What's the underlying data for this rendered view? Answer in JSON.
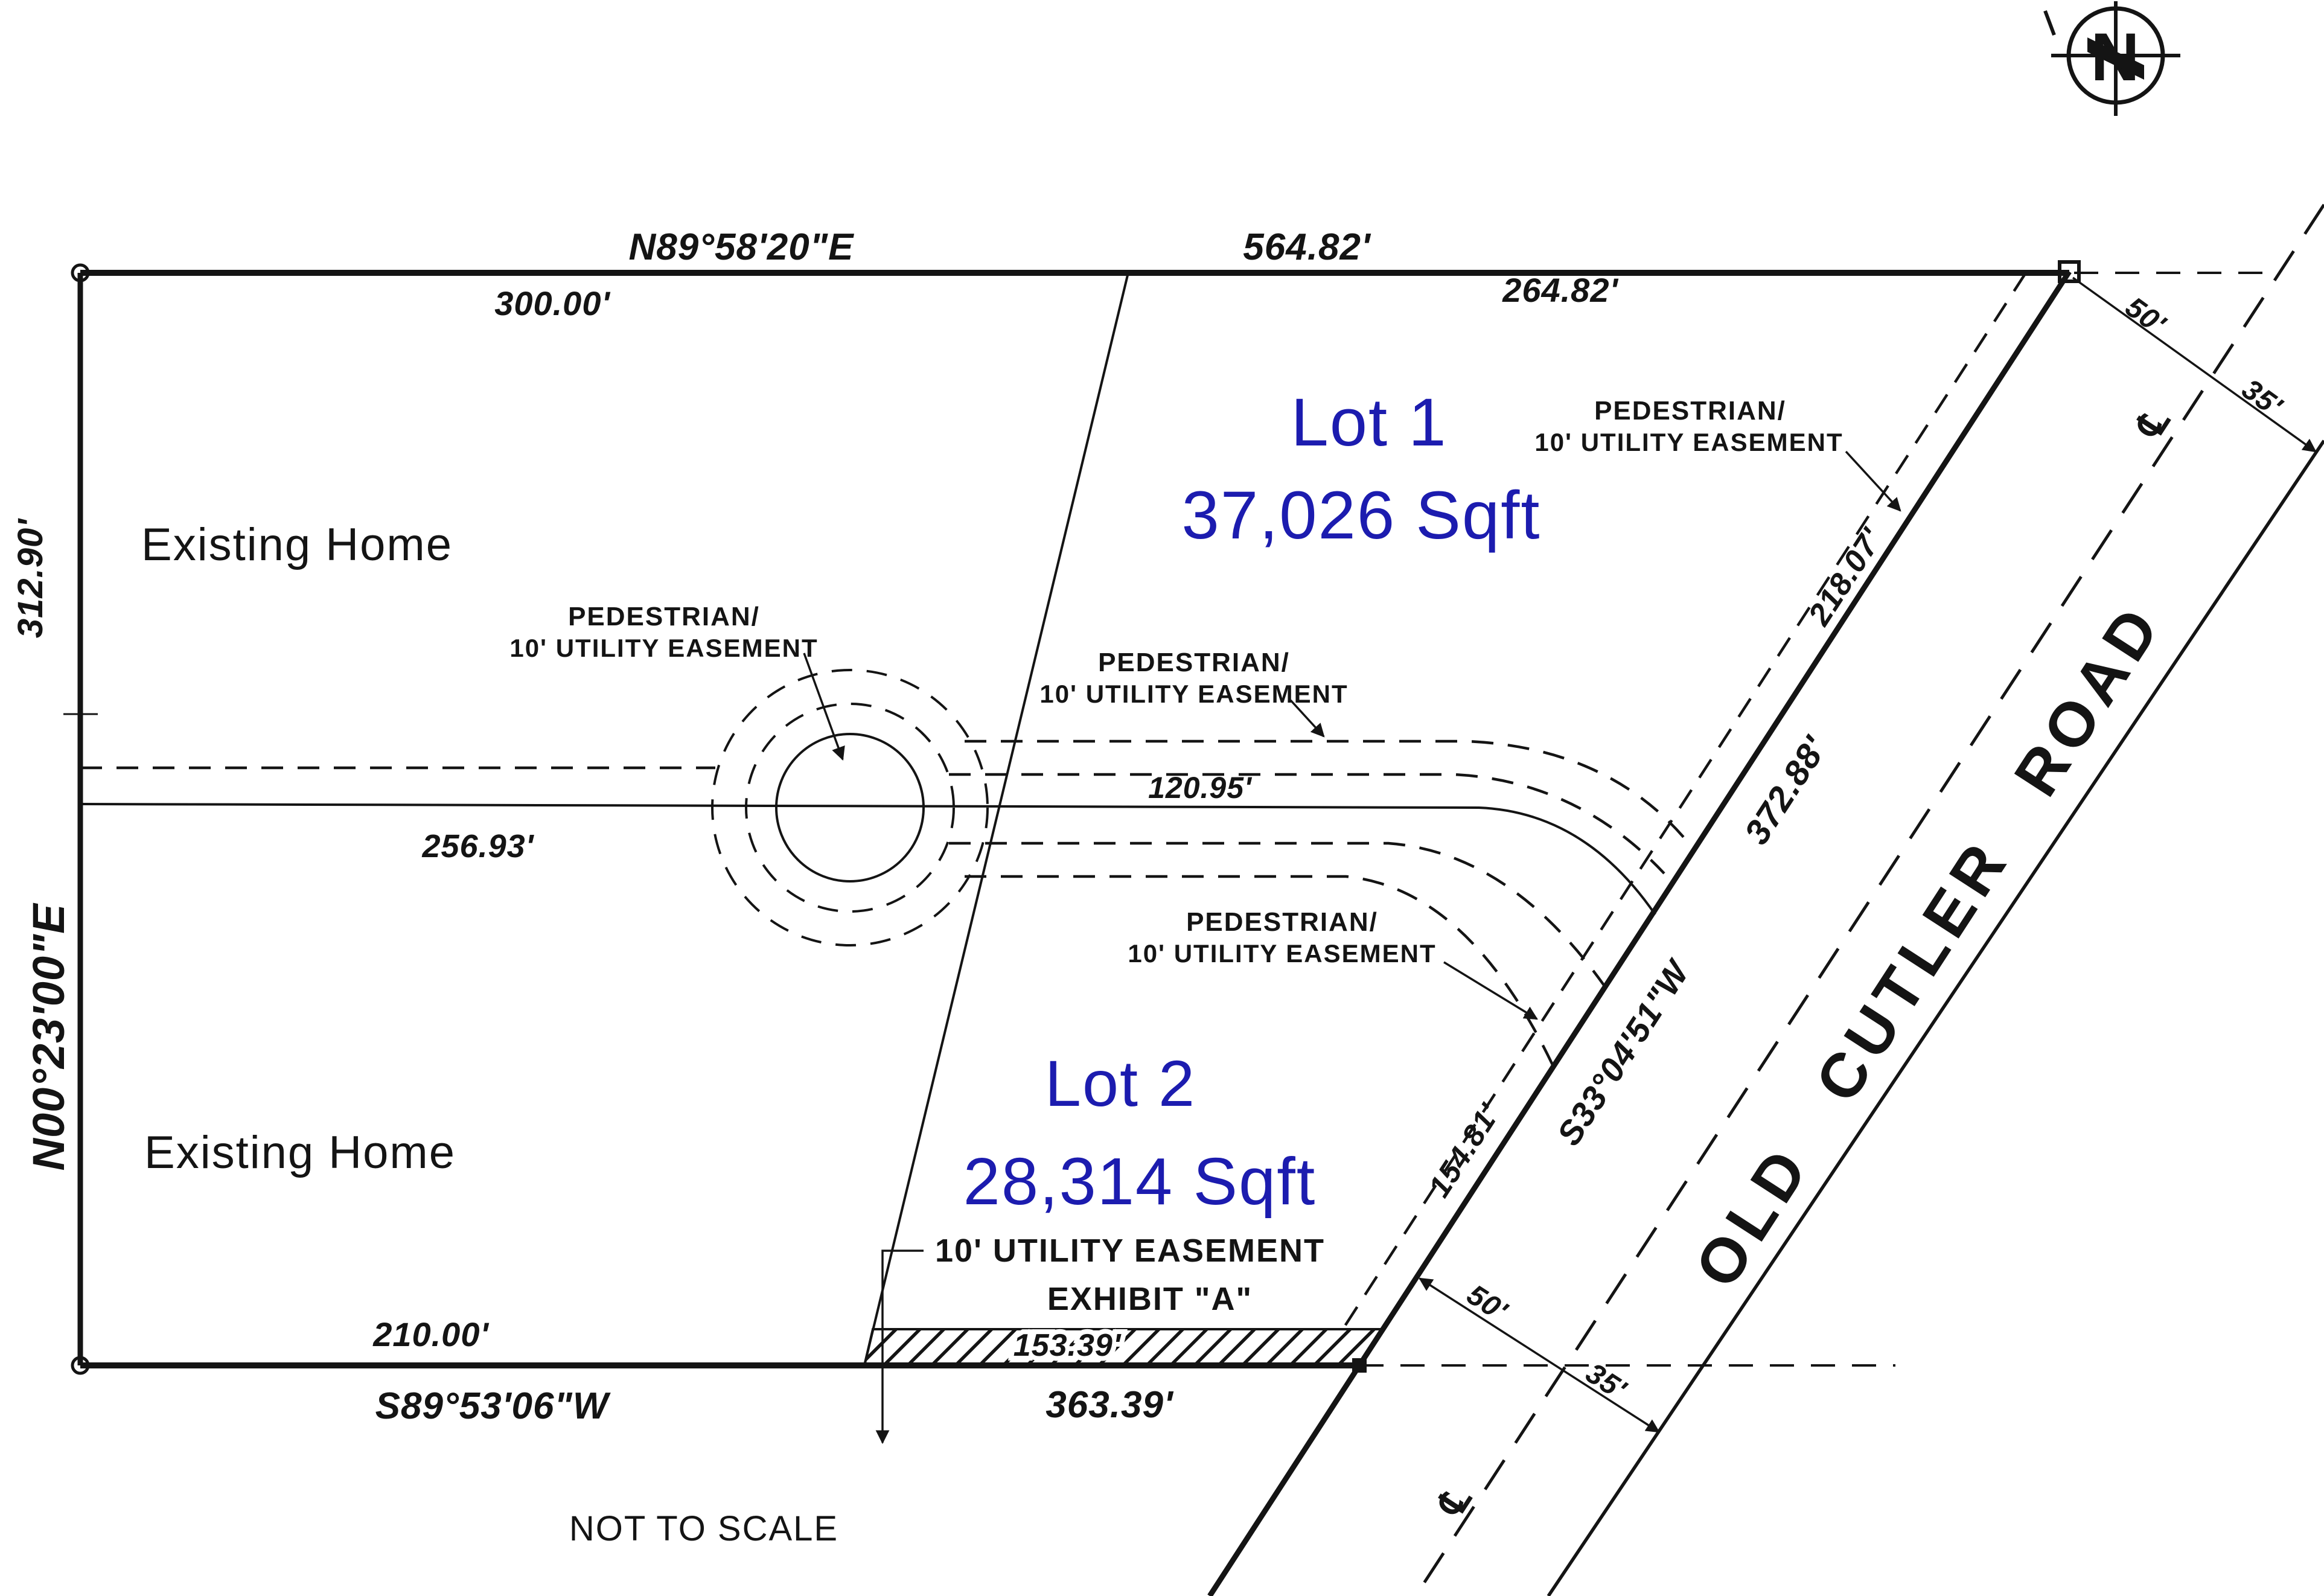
{
  "colors": {
    "ink": "#141414",
    "lot_label_blue": "#1c1caf",
    "paper": "#ffffff"
  },
  "north_arrow": {
    "letter": "N"
  },
  "boundary": {
    "north_bearing": "N89°58'20\"E",
    "north_total": "564.82'",
    "north_left_segment": "300.00'",
    "north_right_segment": "264.82'",
    "west_upper_distance": "312.90'",
    "west_bearing": "N00°23'00\"E",
    "south_left_segment": "210.00'",
    "south_bearing": "S89°53'06\"W",
    "south_total": "363.39'",
    "south_easement_segment": "153.39'",
    "road_bearing": "S33°04'51\"W",
    "road_total": "372.88'",
    "road_upper_segment": "218.07'",
    "road_lower_segment": "154.81'"
  },
  "lots": {
    "lot1_name": "Lot 1",
    "lot1_area": "37,026 Sqft",
    "lot2_name": "Lot 2",
    "lot2_area": "28,314 Sqft"
  },
  "parcels": {
    "existing_home": "Existing Home"
  },
  "interior": {
    "middle_distance": "256.93'",
    "drive_distance": "120.95'"
  },
  "easement": {
    "pedestrian_line1": "PEDESTRIAN/",
    "pedestrian_line2": "10' UTILITY EASEMENT",
    "south_label": "10' UTILITY EASEMENT",
    "exhibit_label": "EXHIBIT \"A\""
  },
  "road": {
    "name": "OLD CUTLER ROAD",
    "west_half_width": "50'",
    "east_half_width": "35'",
    "centerline_symbol": "℄"
  },
  "notes": {
    "scale_note": "NOT TO SCALE"
  }
}
